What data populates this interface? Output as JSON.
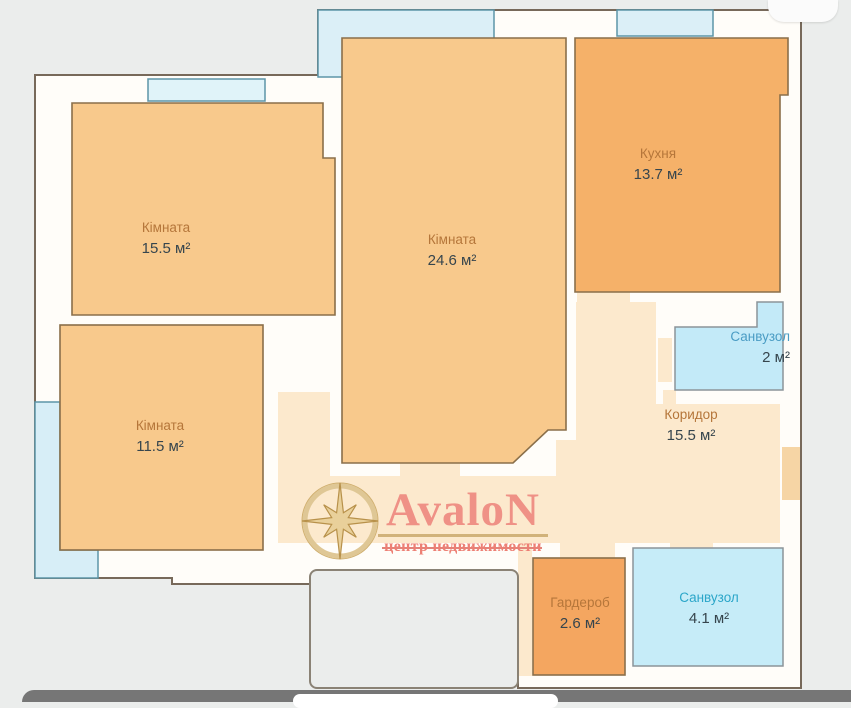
{
  "plan": {
    "rooms": [
      {
        "id": "room-1",
        "name": "Кімната",
        "area": "15.5 м²"
      },
      {
        "id": "room-2",
        "name": "Кімната",
        "area": "24.6 м²"
      },
      {
        "id": "kitchen",
        "name": "Кухня",
        "area": "13.7 м²"
      },
      {
        "id": "bathroom-2",
        "name": "Санвузол",
        "area": "2 м²"
      },
      {
        "id": "room-3",
        "name": "Кімната",
        "area": "11.5 м²"
      },
      {
        "id": "corridor",
        "name": "Коридор",
        "area": "15.5 м²"
      },
      {
        "id": "wardrobe",
        "name": "Гардероб",
        "area": "2.6 м²"
      },
      {
        "id": "bathroom-41",
        "name": "Санвузол",
        "area": "4.1 м²"
      }
    ]
  },
  "logo": {
    "brand": "AvaloN",
    "tagline": "центр недвижимости"
  },
  "icons": {
    "compass": "compass-rose-icon",
    "home_indicator": "home-indicator-pill"
  },
  "colors": {
    "background": "#ebedec",
    "wall_white": "#fffdf9",
    "wall_line": "#77695a",
    "room_light_orange": "#f8c98c",
    "kitchen_orange": "#f5b169",
    "wardrobe_orange": "#f4a660",
    "bathroom_blue": "#c6ecf8",
    "corridor_cream": "#fce9cd",
    "balcony_blue": "#dbeff7",
    "window_border_teal": "#5d95a8",
    "brand_salmon": "#ef9186",
    "brand_red": "#ed7f74",
    "logo_gold": "#c9a86b"
  }
}
